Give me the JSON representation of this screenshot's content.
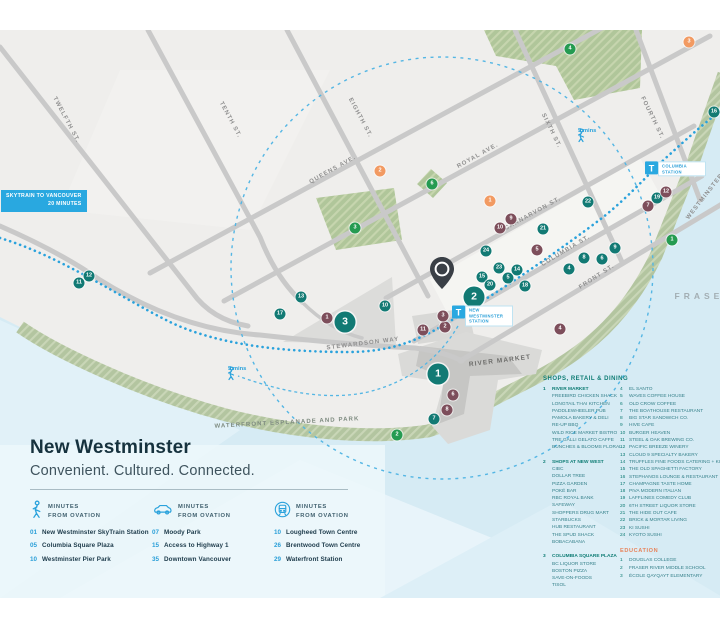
{
  "palette": {
    "shop": "#127a74",
    "poi": "#7d4e5b",
    "park": "#259b51",
    "edu": "#f29a62",
    "accent": "#29a3dc"
  },
  "title_block": {
    "title": "New Westminster",
    "subtitle": "Convenient. Cultured. Connected."
  },
  "map": {
    "skytrain_badge": {
      "line1": "SKYTRAIN TO VANCOUVER",
      "line2": "20 MINUTES",
      "x": 1,
      "y": 160
    },
    "river_label": "FRASER",
    "street_labels": [
      {
        "text": "TWELFTH ST.",
        "x": 66,
        "y": 90,
        "r": 62
      },
      {
        "text": "TENTH ST.",
        "x": 230,
        "y": 90,
        "r": 62
      },
      {
        "text": "EIGHTH ST.",
        "x": 360,
        "y": 88,
        "r": 62
      },
      {
        "text": "SIXTH ST.",
        "x": 551,
        "y": 101,
        "r": 64
      },
      {
        "text": "FOURTH ST.",
        "x": 652,
        "y": 88,
        "r": 64
      },
      {
        "text": "QUEENS AVE.",
        "x": 333,
        "y": 140,
        "r": -29
      },
      {
        "text": "ROYAL AVE.",
        "x": 478,
        "y": 126,
        "r": -29
      },
      {
        "text": "CARNARVON ST.",
        "x": 533,
        "y": 184,
        "r": -29
      },
      {
        "text": "COLUMBIA ST.",
        "x": 566,
        "y": 221,
        "r": -31
      },
      {
        "text": "FRONT ST.",
        "x": 597,
        "y": 247,
        "r": -33
      },
      {
        "text": "WESTMINSTER HWY.",
        "x": 712,
        "y": 158,
        "r": -52
      },
      {
        "text": "STEWARDSON WAY",
        "x": 363,
        "y": 314,
        "r": -7
      },
      {
        "text": "WATERFRONT ESPLANADE AND PARK",
        "x": 287,
        "y": 393,
        "r": -3,
        "cls": "park"
      },
      {
        "text": "RIVER MARKET",
        "x": 500,
        "y": 331,
        "r": -7,
        "cls": "building"
      },
      {
        "text": "FRASER",
        "x": 704,
        "y": 266,
        "r": 0,
        "cls": "river"
      }
    ],
    "stations": [
      {
        "t": "T",
        "label": "COLUMBIA STATION",
        "x": 645,
        "y": 139
      },
      {
        "t": "T",
        "label": "NEW WESTMINSTER STATION",
        "x": 452,
        "y": 286
      }
    ],
    "walk_points": [
      {
        "label": "5 mins",
        "x": 578,
        "y": 100
      },
      {
        "label": "5 mins",
        "x": 228,
        "y": 338
      }
    ],
    "pin": {
      "x": 427,
      "y": 226
    },
    "markers": [
      {
        "n": "1",
        "cat": "shop",
        "size": "lg",
        "x": 438,
        "y": 344
      },
      {
        "n": "2",
        "cat": "shop",
        "size": "lg",
        "x": 474,
        "y": 267
      },
      {
        "n": "3",
        "cat": "shop",
        "size": "lg",
        "x": 345,
        "y": 292
      },
      {
        "n": "4",
        "cat": "shop",
        "x": 569,
        "y": 239
      },
      {
        "n": "5",
        "cat": "shop",
        "x": 508,
        "y": 248
      },
      {
        "n": "6",
        "cat": "shop",
        "x": 602,
        "y": 229
      },
      {
        "n": "7",
        "cat": "shop",
        "x": 434,
        "y": 389
      },
      {
        "n": "8",
        "cat": "shop",
        "x": 584,
        "y": 228
      },
      {
        "n": "9",
        "cat": "shop",
        "x": 615,
        "y": 218
      },
      {
        "n": "10",
        "cat": "shop",
        "x": 385,
        "y": 276
      },
      {
        "n": "11",
        "cat": "shop",
        "x": 79,
        "y": 253
      },
      {
        "n": "12",
        "cat": "shop",
        "x": 89,
        "y": 246
      },
      {
        "n": "13",
        "cat": "shop",
        "x": 301,
        "y": 267
      },
      {
        "n": "14",
        "cat": "shop",
        "x": 517,
        "y": 240
      },
      {
        "n": "15",
        "cat": "shop",
        "x": 482,
        "y": 247
      },
      {
        "n": "16",
        "cat": "shop",
        "x": 714,
        "y": 82
      },
      {
        "n": "17",
        "cat": "shop",
        "x": 280,
        "y": 284
      },
      {
        "n": "18",
        "cat": "shop",
        "x": 525,
        "y": 256
      },
      {
        "n": "19",
        "cat": "shop",
        "x": 657,
        "y": 168
      },
      {
        "n": "20",
        "cat": "shop",
        "x": 490,
        "y": 255
      },
      {
        "n": "21",
        "cat": "shop",
        "x": 543,
        "y": 199
      },
      {
        "n": "22",
        "cat": "shop",
        "x": 588,
        "y": 172
      },
      {
        "n": "23",
        "cat": "shop",
        "x": 499,
        "y": 238
      },
      {
        "n": "24",
        "cat": "shop",
        "x": 486,
        "y": 221
      },
      {
        "n": "1",
        "cat": "poi",
        "x": 327,
        "y": 288
      },
      {
        "n": "2",
        "cat": "poi",
        "x": 445,
        "y": 297
      },
      {
        "n": "3",
        "cat": "poi",
        "x": 443,
        "y": 286
      },
      {
        "n": "4",
        "cat": "poi",
        "x": 560,
        "y": 299
      },
      {
        "n": "5",
        "cat": "poi",
        "x": 537,
        "y": 220
      },
      {
        "n": "6",
        "cat": "poi",
        "x": 453,
        "y": 365
      },
      {
        "n": "7",
        "cat": "poi",
        "x": 648,
        "y": 176
      },
      {
        "n": "8",
        "cat": "poi",
        "x": 447,
        "y": 380
      },
      {
        "n": "9",
        "cat": "poi",
        "x": 511,
        "y": 189
      },
      {
        "n": "10",
        "cat": "poi",
        "x": 500,
        "y": 198
      },
      {
        "n": "11",
        "cat": "poi",
        "x": 423,
        "y": 300
      },
      {
        "n": "12",
        "cat": "poi",
        "x": 666,
        "y": 162
      },
      {
        "n": "1",
        "cat": "park",
        "x": 672,
        "y": 210
      },
      {
        "n": "2",
        "cat": "park",
        "x": 397,
        "y": 405
      },
      {
        "n": "3",
        "cat": "park",
        "x": 355,
        "y": 198
      },
      {
        "n": "4",
        "cat": "park",
        "x": 570,
        "y": 19
      },
      {
        "n": "6",
        "cat": "park",
        "x": 432,
        "y": 154
      },
      {
        "n": "1",
        "cat": "edu",
        "x": 490,
        "y": 171
      },
      {
        "n": "2",
        "cat": "edu",
        "x": 380,
        "y": 141
      },
      {
        "n": "3",
        "cat": "edu",
        "x": 689,
        "y": 12
      }
    ]
  },
  "minutes": {
    "columns": [
      {
        "icon": "walk",
        "header_line1": "MINUTES",
        "header_line2": "FROM OVATION",
        "items": [
          {
            "num": "01",
            "label": "New Westminster SkyTrain Station"
          },
          {
            "num": "05",
            "label": "Columbia Square Plaza"
          },
          {
            "num": "10",
            "label": "Westminster Pier Park"
          }
        ]
      },
      {
        "icon": "car",
        "header_line1": "MINUTES",
        "header_line2": "FROM OVATION",
        "items": [
          {
            "num": "07",
            "label": "Moody Park"
          },
          {
            "num": "15",
            "label": "Access to Highway 1"
          },
          {
            "num": "35",
            "label": "Downtown Vancouver"
          }
        ]
      },
      {
        "icon": "train",
        "header_line1": "MINUTES",
        "header_line2": "FROM OVATION",
        "items": [
          {
            "num": "10",
            "label": "Lougheed Town Centre"
          },
          {
            "num": "26",
            "label": "Brentwood Town Centre"
          },
          {
            "num": "29",
            "label": "Waterfront Station"
          }
        ]
      }
    ]
  },
  "legend": {
    "title": "SHOPS, RETAIL & DINING",
    "groups": [
      {
        "num": "1",
        "name": "RIVER MARKET",
        "items": [
          "FREEBIRD CHICKEN SHACK",
          "LONGTAIL THAI KITCHEN",
          "PADDLEWHEELER PUB",
          "PAMOLA BAKERY & DELI",
          "RE-UP BBQ",
          "WILD RICE MARKET BISTRO",
          "TRE GALLI GELATO CAFFE",
          "BUNCHES & BLOOMS FLORAL"
        ]
      },
      {
        "num": "2",
        "name": "SHOPS AT NEW WEST",
        "items": [
          "CIBC",
          "DOLLAR TREE",
          "PIZZA GARDEN",
          "POKÉ BAR",
          "RBC ROYAL BANK",
          "SAFEWAY",
          "SHOPPERS DRUG MART",
          "STARBUCKS",
          "HUB RESTAURANT",
          "THE SPUD SHACK",
          "BOBACABANA"
        ]
      },
      {
        "num": "3",
        "name": "COLUMBIA SQUARE PLAZA",
        "items": [
          "BC LIQUOR STORE",
          "BOSTON PIZZA",
          "SAVE-ON-FOODS",
          "TISOL"
        ]
      }
    ],
    "places": [
      {
        "num": "4",
        "name": "EL SANTO"
      },
      {
        "num": "5",
        "name": "WAVES COFFEE HOUSE"
      },
      {
        "num": "6",
        "name": "OLD CROW COFFEE"
      },
      {
        "num": "7",
        "name": "THE BOATHOUSE RESTAURANT"
      },
      {
        "num": "8",
        "name": "BIG STAR SANDWICH CO."
      },
      {
        "num": "9",
        "name": "HIVE CAFE"
      },
      {
        "num": "10",
        "name": "BURGER HEAVEN"
      },
      {
        "num": "11",
        "name": "STEEL & OAK BREWING CO."
      },
      {
        "num": "12",
        "name": "PACIFIC BREEZE WINERY"
      },
      {
        "num": "13",
        "name": "CLOUD 9 SPECIALTY BAKERY"
      },
      {
        "num": "14",
        "name": "TRUFFLES FINE FOODS CATERING + KITCHENS"
      },
      {
        "num": "15",
        "name": "THE OLD SPAGHETTI FACTORY"
      },
      {
        "num": "16",
        "name": "STEPHANOS LOUNGE & RESTAURANT"
      },
      {
        "num": "17",
        "name": "CHAMPAGNE TASTE HOME"
      },
      {
        "num": "18",
        "name": "PIVA MODERN ITALIAN"
      },
      {
        "num": "19",
        "name": "LAFFLINES COMEDY CLUB"
      },
      {
        "num": "20",
        "name": "6TH STREET LIQUOR STORE"
      },
      {
        "num": "21",
        "name": "THE HIDE OUT CAFE"
      },
      {
        "num": "22",
        "name": "BRICK & MORTAR LIVING"
      },
      {
        "num": "23",
        "name": "KI SUSHI"
      },
      {
        "num": "24",
        "name": "KYOTO SUSHI"
      }
    ]
  },
  "education": {
    "title": "EDUCATION",
    "items": [
      {
        "num": "1",
        "name": "DOUGLAS COLLEGE"
      },
      {
        "num": "2",
        "name": "FRASER RIVER MIDDLE SCHOOL"
      },
      {
        "num": "3",
        "name": "ÉCOLE QAYQAYT ELEMENTARY"
      }
    ]
  }
}
